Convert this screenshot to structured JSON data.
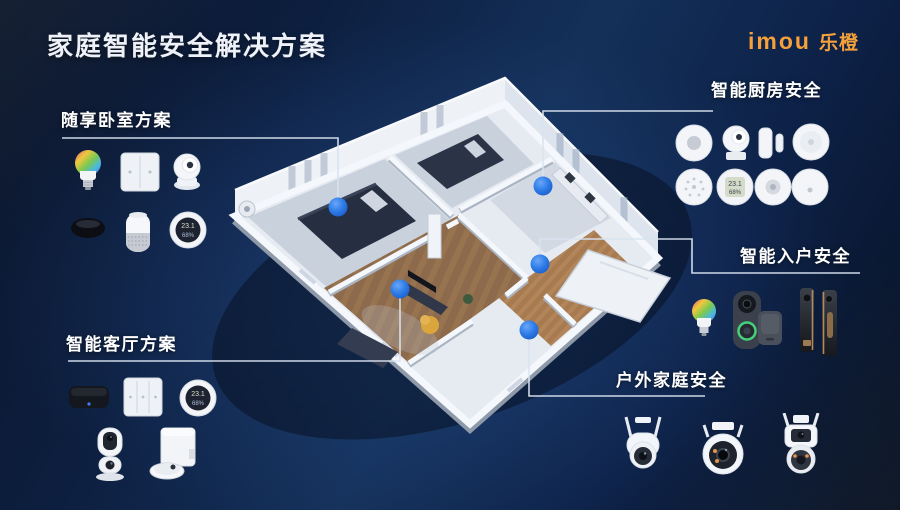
{
  "title": "家庭智能安全解决方案",
  "logo": {
    "brand_en": "imou",
    "brand_cn": "乐橙"
  },
  "colors": {
    "accent_orange": "#f5a03a",
    "marker_blue": "#2e7ce8",
    "connector_line": "#d9e3f0",
    "background_navy": "#0d2145"
  },
  "sections": {
    "bedroom": {
      "label": "随享卧室方案",
      "products": [
        "smart-bulb",
        "wall-switch-2gang",
        "indoor-camera",
        "presence-sensor",
        "smart-speaker",
        "temp-humidity-sensor"
      ]
    },
    "living": {
      "label": "智能客厅方案",
      "products": [
        "smart-gateway",
        "wall-switch-3gang",
        "temp-humidity-sensor",
        "dual-lens-indoor-camera",
        "robot-vacuum-station"
      ]
    },
    "kitchen": {
      "label": "智能厨房安全",
      "products": [
        "gas-detector",
        "mini-camera",
        "door-window-sensor",
        "smoke-detector",
        "siren",
        "lcd-temp-humidity-sensor",
        "motion-sensor",
        "smart-button"
      ]
    },
    "entry": {
      "label": "智能入户安全",
      "products": [
        "smart-bulb",
        "video-doorbell",
        "doorbell-chime",
        "smart-door-lock"
      ]
    },
    "outdoor": {
      "label": "户外家庭安全",
      "products": [
        "ptz-outdoor-camera",
        "dome-outdoor-camera",
        "dual-lens-outdoor-camera"
      ]
    }
  },
  "sensor_display": {
    "temperature": "23.1",
    "humidity": "68%"
  }
}
